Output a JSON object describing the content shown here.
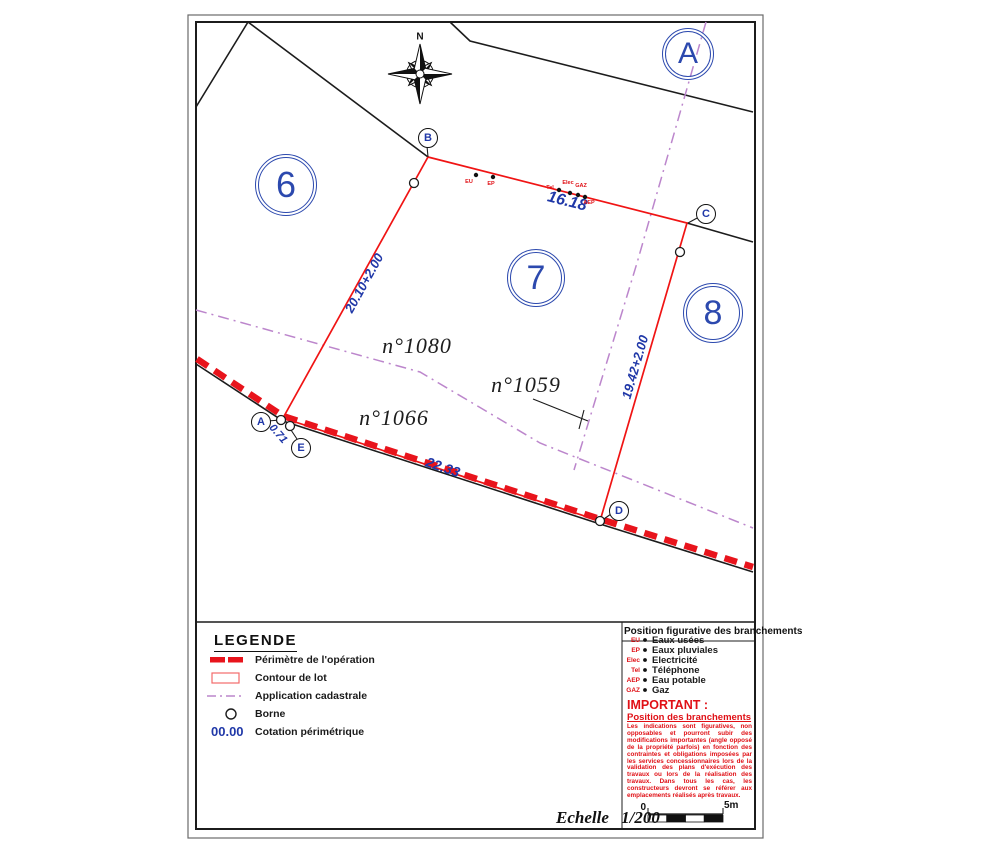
{
  "plan": {
    "north": "N",
    "zones": {
      "a": "A",
      "lot6": "6",
      "lot7": "7",
      "lot8": "8"
    },
    "points": {
      "b": "B",
      "c": "C",
      "d": "D",
      "e": "E",
      "a": "A"
    },
    "parcels": {
      "n1080": "n°1080",
      "n1059": "n°1059",
      "n1066": "n°1066"
    },
    "dimensions": {
      "top": "16.18",
      "left": "20.10+2.00",
      "right": "19.42+2.00",
      "bottom": "22.33",
      "ae": "0.71"
    },
    "marks": {
      "eu": "EU",
      "ep": "EP",
      "tel": "Tel",
      "elec": "Elec",
      "gaz": "GAZ",
      "aep": "AEP"
    }
  },
  "legend": {
    "title": "LEGENDE",
    "items": [
      {
        "label": "Périmètre de l'opération"
      },
      {
        "label": "Contour de lot"
      },
      {
        "label": "Application cadastrale"
      },
      {
        "label": "Borne"
      },
      {
        "symbol_text": "00.00",
        "label": "Cotation périmétrique"
      }
    ]
  },
  "branchements": {
    "title": "Position figurative des branchements",
    "items": [
      {
        "abbr": "EU",
        "label": "Eaux usées"
      },
      {
        "abbr": "EP",
        "label": "Eaux pluviales"
      },
      {
        "abbr": "Elec",
        "label": "Electricité"
      },
      {
        "abbr": "Tel",
        "label": "Téléphone"
      },
      {
        "abbr": "AEP",
        "label": "Eau potable"
      },
      {
        "abbr": "GAZ",
        "label": "Gaz"
      }
    ],
    "important_title": "IMPORTANT :",
    "important_subtitle": "Position des branchements",
    "important_body": "Les indications sont figuratives, non opposables et pourront subir des modifications importantes (angle opposé de la propriété parfois) en fonction des contraintes et obligations imposées par les services concessionnaires lors de la validation des plans d'exécution des travaux ou lors de la réalisation des travaux. Dans tous les cas, les constructeurs devront se référer aux emplacements réalisés après travaux."
  },
  "scale": {
    "label": "Echelle 1/200",
    "zero": "0",
    "max": "5m"
  },
  "colors": {
    "red": "#e8141c",
    "blue": "#2038a8",
    "purple": "#bc86cc",
    "black": "#1c1c1c"
  }
}
